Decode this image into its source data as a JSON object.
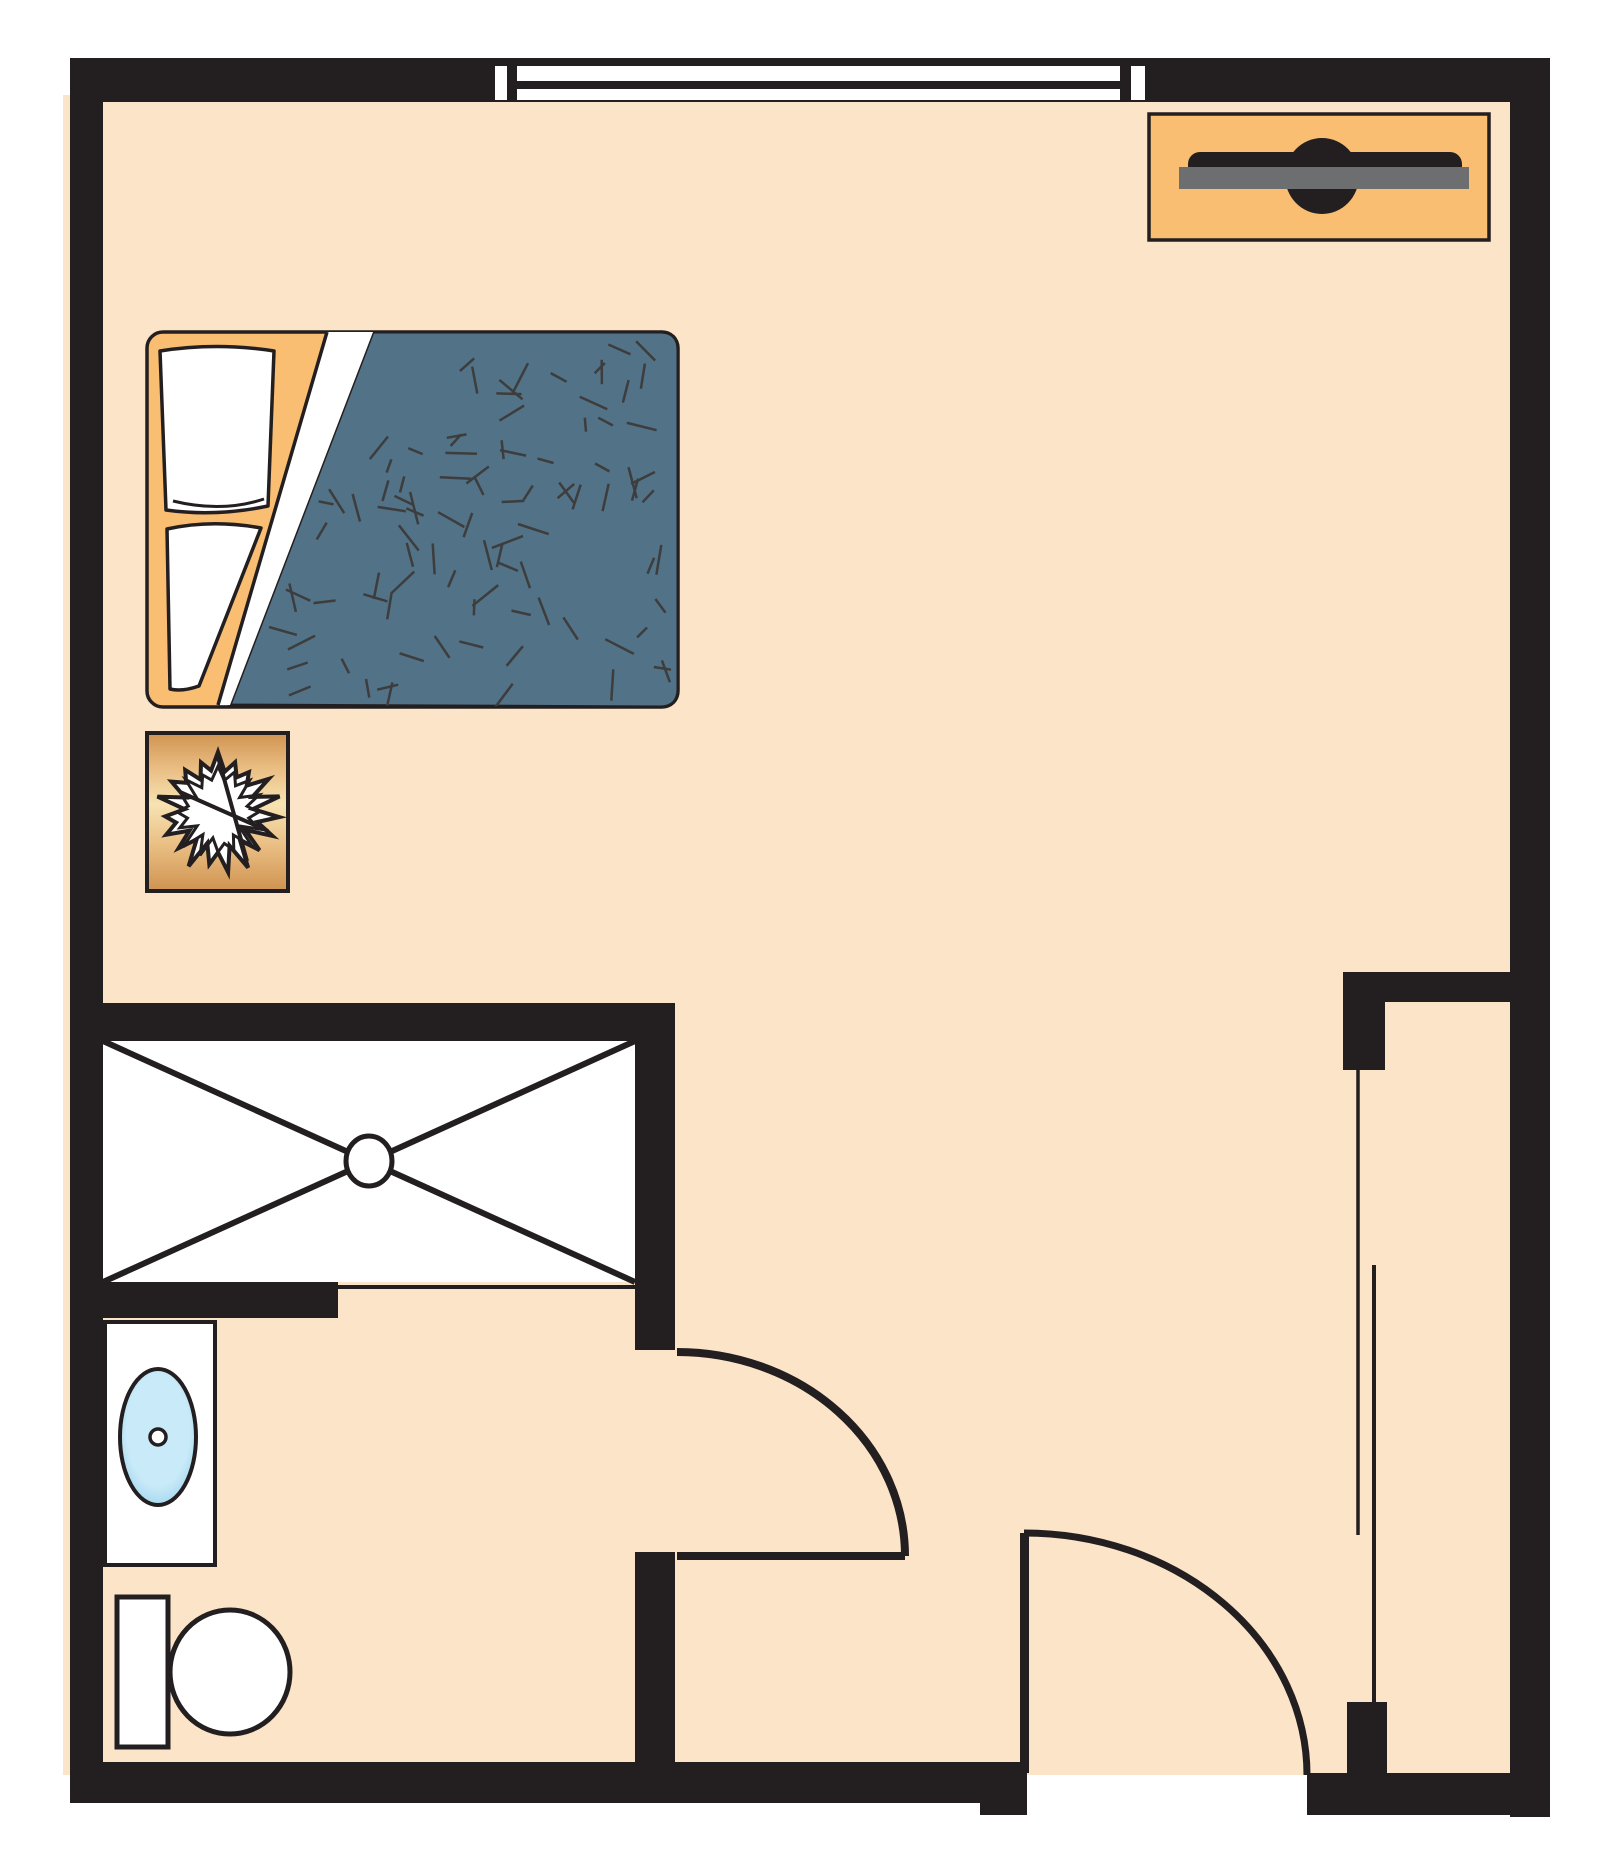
{
  "page": {
    "title": "Studio room floor plan",
    "background": "#ffffff"
  },
  "colors": {
    "wall": "#231f20",
    "floor": "#fce4c8",
    "accent_orange": "#f9be71",
    "blanket": "#527287",
    "blanket_dash": "#3d3d3d",
    "white": "#ffffff",
    "gray_shelf": "#6d6e70",
    "nightstand_dark": "#cf9350",
    "nightstand_mid": "#e9bd82",
    "nightstand_light": "#f7e3b2",
    "sink_outer": "#7cc3e6",
    "sink_inner": "#c9eaf8"
  },
  "fixtures": {
    "window": {
      "label": "window"
    },
    "tv_console": {
      "label": "tv-console"
    },
    "bed": {
      "label": "bed",
      "dash_count": 95,
      "dash_seed": 11
    },
    "nightstand": {
      "label": "nightstand",
      "star": {
        "cx": 218,
        "cy": 812,
        "points": 19,
        "outer_r": 57,
        "inner_r": 38,
        "jitter": 0.14,
        "seed": 5,
        "inner_outline": {
          "points": 16,
          "outer_r": 43,
          "inner_r": 29
        },
        "lines": [
          [
            180,
            792,
            268,
            831
          ],
          [
            218,
            757,
            247,
            861
          ]
        ]
      }
    },
    "shower": {
      "label": "shower-stall"
    },
    "sink": {
      "label": "bathroom-vanity-sink"
    },
    "toilet": {
      "label": "toilet"
    },
    "bathroom_door": {
      "label": "bathroom-door"
    },
    "entry_door": {
      "label": "entry-door"
    },
    "closet": {
      "label": "closet-sliding-doors"
    }
  }
}
